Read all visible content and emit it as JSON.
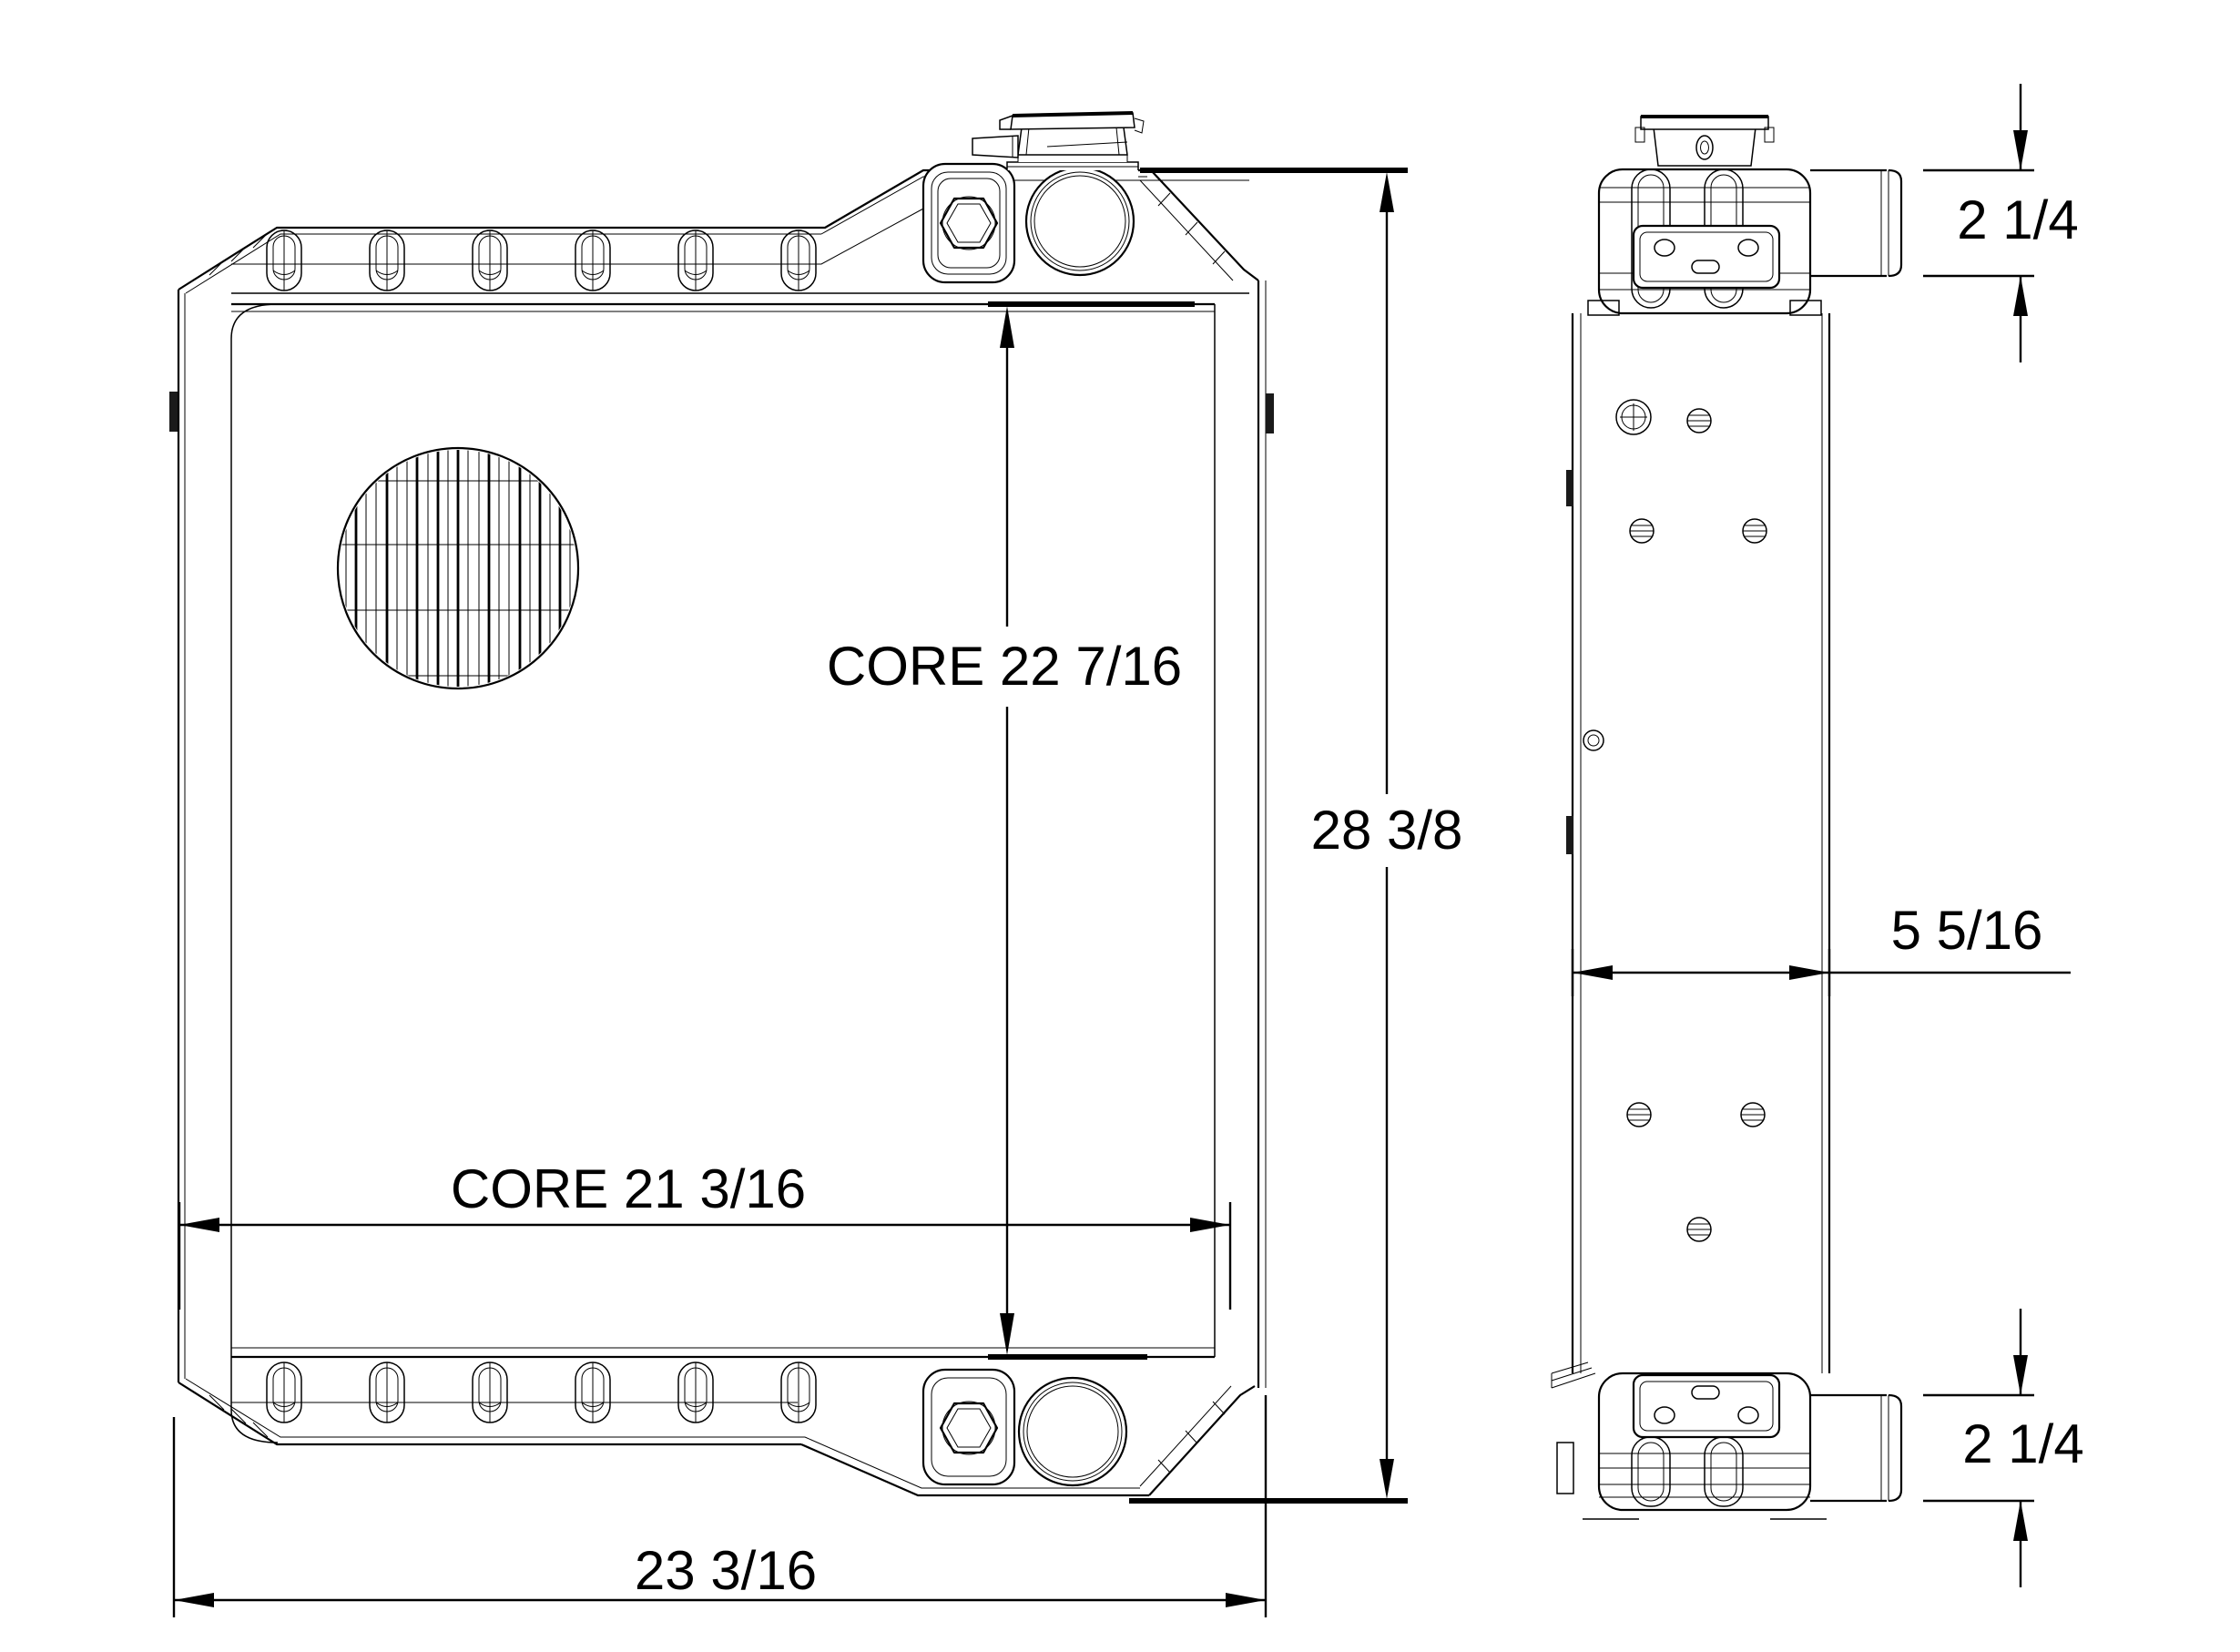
{
  "colors": {
    "background": "#ffffff",
    "line": "#000000"
  },
  "front_view": {
    "core_height_label": "CORE 22 7/16",
    "overall_height_label": "28 3/8",
    "core_width_label": "CORE 21 3/16",
    "overall_width_label": "23 3/16"
  },
  "side_view": {
    "inlet_height_label": "2 1/4",
    "depth_label": "5 5/16",
    "outlet_height_label": "2 1/4"
  }
}
